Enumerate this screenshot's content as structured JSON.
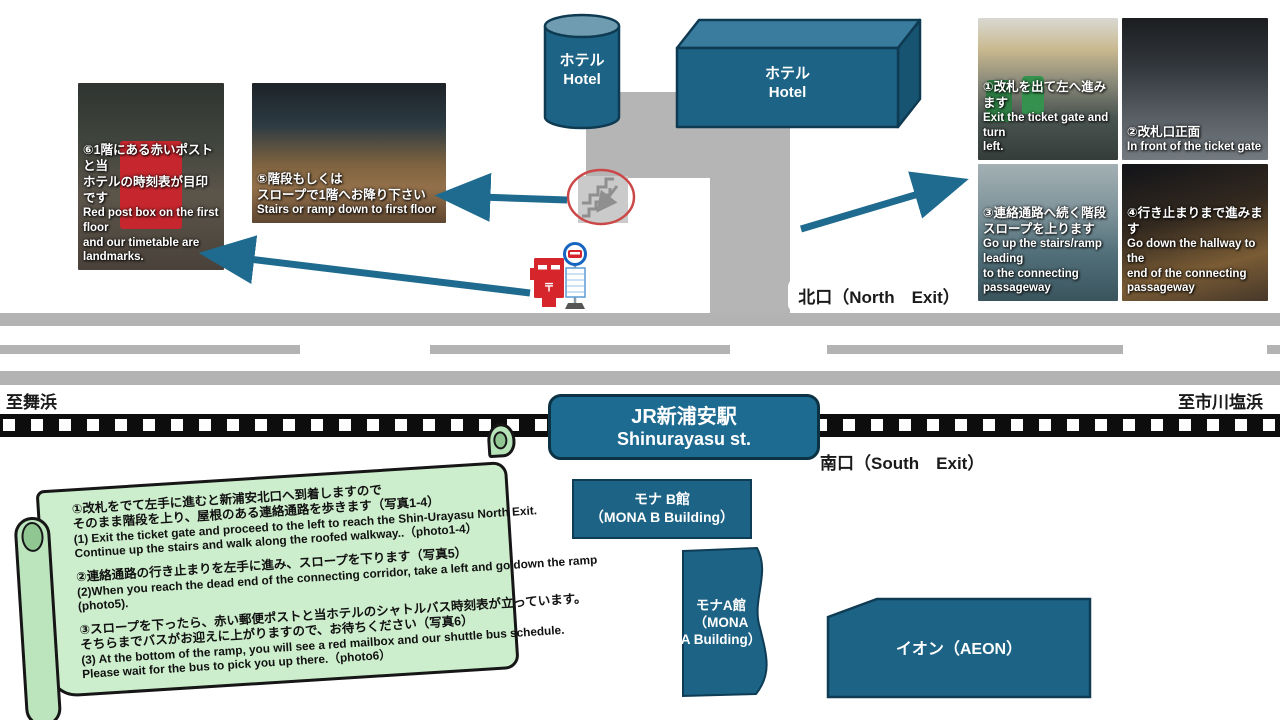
{
  "map": {
    "directions": {
      "to_left": "至舞浜",
      "to_right": "至市川塩浜"
    },
    "exits": {
      "north": "北口（North　Exit）",
      "south": "南口（South　Exit）"
    },
    "station": {
      "jp": "JR新浦安駅",
      "en": "Shinurayasu st."
    },
    "hotel_tower": {
      "jp": "ホテル",
      "en": "Hotel"
    },
    "hotel_block": {
      "jp": "ホテル",
      "en": "Hotel"
    },
    "buildings": {
      "mona_b": {
        "lines": [
          "モナ B館",
          "（MONA B Building）"
        ]
      },
      "mona_a": {
        "lines": [
          "モナA館",
          "（MONA",
          "A Building）"
        ]
      },
      "aeon": {
        "label": "イオン（AEON）"
      }
    }
  },
  "photos": {
    "p1": {
      "jp": [
        "①改札を出て左へ進みます"
      ],
      "en": [
        "Exit the ticket gate and turn",
        "left."
      ]
    },
    "p2": {
      "jp": [
        "②改札口正面"
      ],
      "en": [
        "In front of the ticket gate"
      ]
    },
    "p3": {
      "jp": [
        "③連絡通路へ続く階段",
        "スロープを上ります"
      ],
      "en": [
        "Go up the stairs/ramp leading",
        "to the connecting",
        "passageway"
      ]
    },
    "p4": {
      "jp": [
        "④行き止まりまで進みます"
      ],
      "en": [
        "Go down the hallway to the",
        "end of the connecting",
        "passageway"
      ]
    },
    "p5": {
      "jp": [
        "⑤階段もしくは",
        "スロープで1階へお降り下さい"
      ],
      "en": [
        "Stairs or ramp down to first floor"
      ]
    },
    "p6": {
      "jp": [
        "⑥1階にある赤いポストと当",
        "ホテルの時刻表が目印です"
      ],
      "en": [
        "Red post box on the first floor",
        "and our timetable are",
        "landmarks."
      ]
    }
  },
  "scroll": {
    "paragraphs": [
      {
        "lines": [
          "①改札をでて左手に進むと新浦安北口へ到着しますので",
          "そのまま階段を上り、屋根のある連絡通路を歩きます（写真1-4）",
          "(1) Exit the ticket gate and proceed to the left to reach the Shin-Urayasu North Exit.",
          "Continue up the stairs and walk along the roofed walkway..（photo1-4）"
        ]
      },
      {
        "lines": [
          "②連絡通路の行き止まりを左手に進み、スロープを下ります（写真5）",
          "(2)When you reach the dead end of the connecting corridor, take a left and go down the ramp",
          "(photo5)."
        ]
      },
      {
        "lines": [
          "③スロープを下ったら、赤い郵便ポストと当ホテルのシャトルバス時刻表が立っています。",
          "そちらまでバスがお迎えに上がりますので、お待ちください（写真6）",
          "(3) At the bottom of the ramp, you will see a red mailbox and our shuttle bus schedule.",
          "Please wait for the bus to pick you up there.（photo6）"
        ]
      }
    ]
  },
  "icons": {
    "postbox_mark": "〒"
  },
  "colors": {
    "building_teal": "#1d6385",
    "building_top": "#3a7c9e",
    "building_side": "#175471",
    "outline_navy": "#0e3a52",
    "arrow_teal": "#1f6b8f",
    "road_gray": "#b3b3b3",
    "scroll_green": "#cdeecd",
    "postbox_red": "#d6262c",
    "rail_black": "#0d0d0d"
  }
}
